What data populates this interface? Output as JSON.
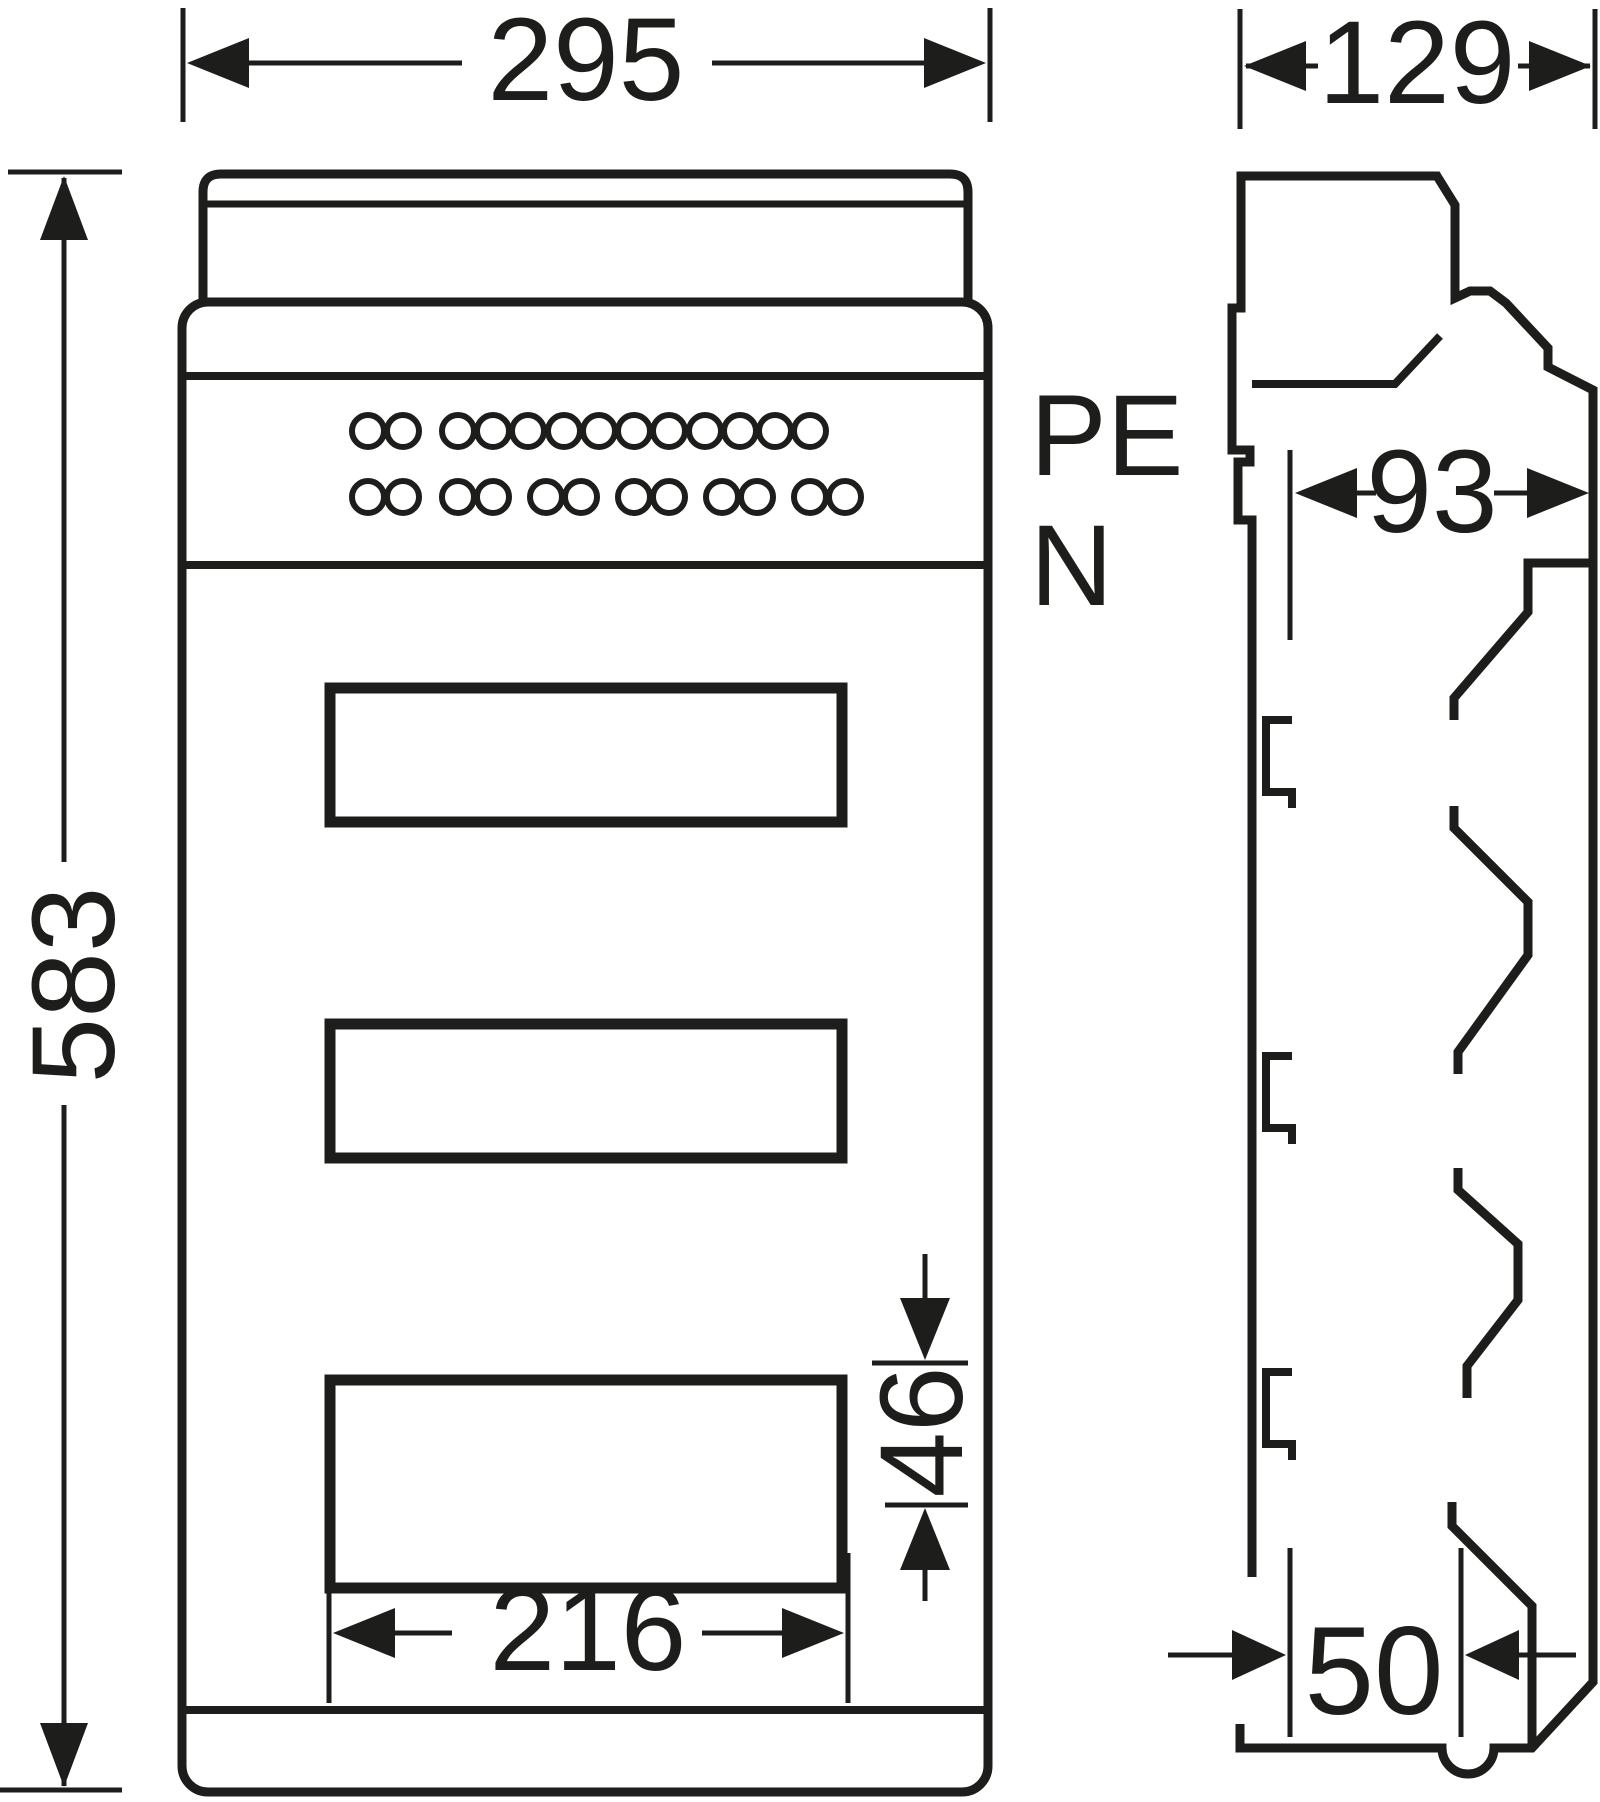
{
  "drawing": {
    "type": "technical-dimension-drawing",
    "subject": "wall-mounted electrical distribution enclosure, front and side views",
    "colors": {
      "ink": "#1d1d1b",
      "background": "#ffffff"
    },
    "labels": {
      "pe_terminal": "PE",
      "n_terminal": "N"
    },
    "dimensions": {
      "overall_width": "295",
      "overall_height": "583",
      "overall_depth": "129",
      "inner_depth": "93",
      "cutout_width": "216",
      "cutout_height": "46",
      "bottom_depth": "50"
    },
    "front_view": {
      "windows": 3,
      "terminal_rows": [
        {
          "cy": 431,
          "cx": [
            368,
            403,
            458,
            493,
            528,
            564,
            599,
            634,
            669,
            705,
            740,
            775,
            810
          ]
        },
        {
          "cy": 497,
          "cx": [
            368,
            403,
            458,
            493,
            546,
            581,
            634,
            669,
            722,
            757,
            810,
            845
          ]
        }
      ],
      "hole_radius": 16
    }
  }
}
